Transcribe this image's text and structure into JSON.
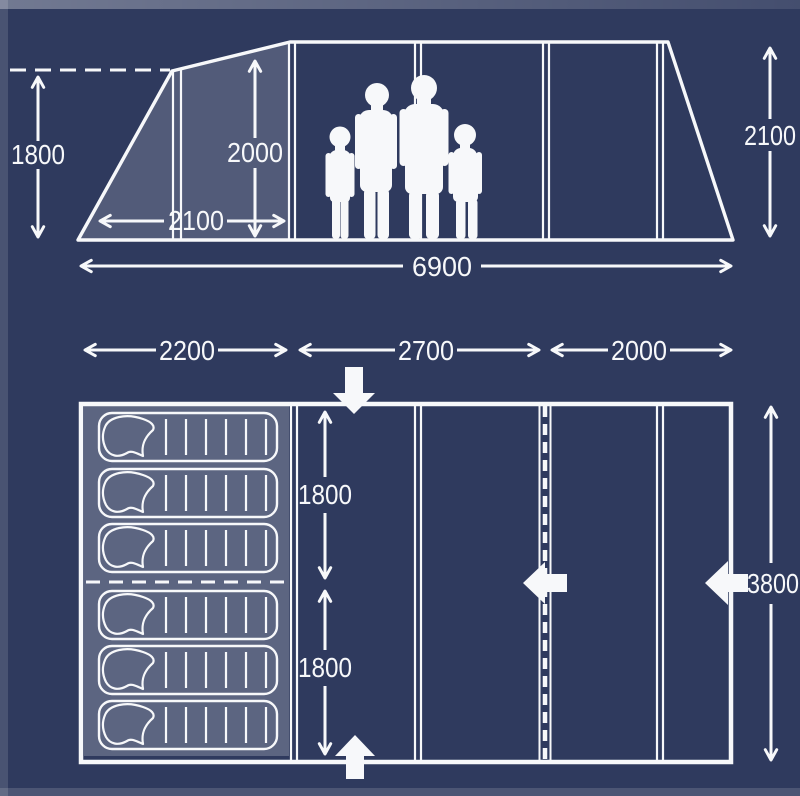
{
  "diagram": {
    "title": "tent-dimensions-diagram",
    "side_view": {
      "peak_height": "1800",
      "interior_height": "2000",
      "porch_depth": "2100",
      "rear_height": "2100",
      "total_length": "6900"
    },
    "floor_plan": {
      "bedroom_width": "2200",
      "living_width": "2700",
      "front_width": "2000",
      "bedroom_depth_top": "1800",
      "bedroom_depth_bottom": "1800",
      "total_width": "3800",
      "sleeping_bag_count": "6"
    },
    "icons": {
      "entrance_top": "down-block-arrow-icon",
      "entrance_bottom": "up-block-arrow-icon",
      "door_side": "left-block-arrow-icon",
      "door_right_wall": "left-block-arrow-icon"
    },
    "colors": {
      "background": "#2f3a5e",
      "line": "#f7f8fa",
      "shaded_panel": "rgba(255,255,255,0.17)",
      "bedroom_floor": "rgba(255,255,255,0.22)"
    }
  }
}
